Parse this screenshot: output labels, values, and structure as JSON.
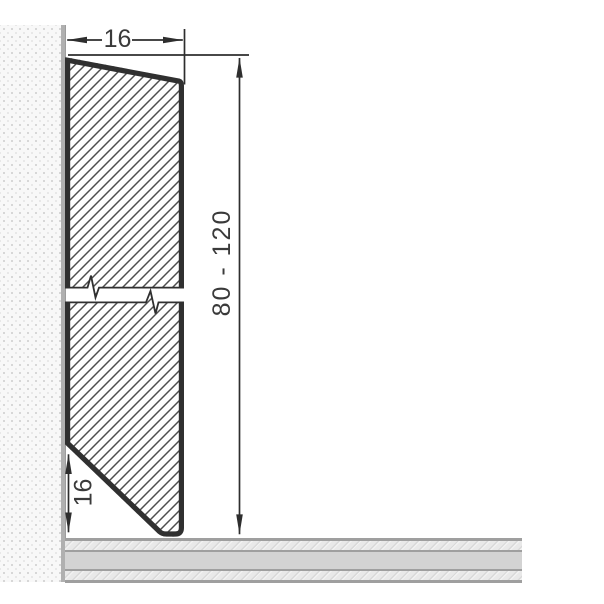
{
  "drawing": {
    "name": "Skirting board profile cross-section",
    "labels": {
      "width": "16",
      "height_range": "80 - 120",
      "chamfer_height": "16"
    },
    "colors": {
      "outline": "#303030",
      "hatch": "#4f4f4f",
      "dimension": "#2e2e2e",
      "text": "#3a3a3a",
      "wall_background": "#f8f8f8",
      "wall_dot": "#cccccc",
      "wall_edge": "#b0b0b0",
      "floor_line": "#9f9f9f",
      "floor_solid": "#d3d3d3",
      "floor_hatch_background": "#e9e9e9"
    }
  }
}
